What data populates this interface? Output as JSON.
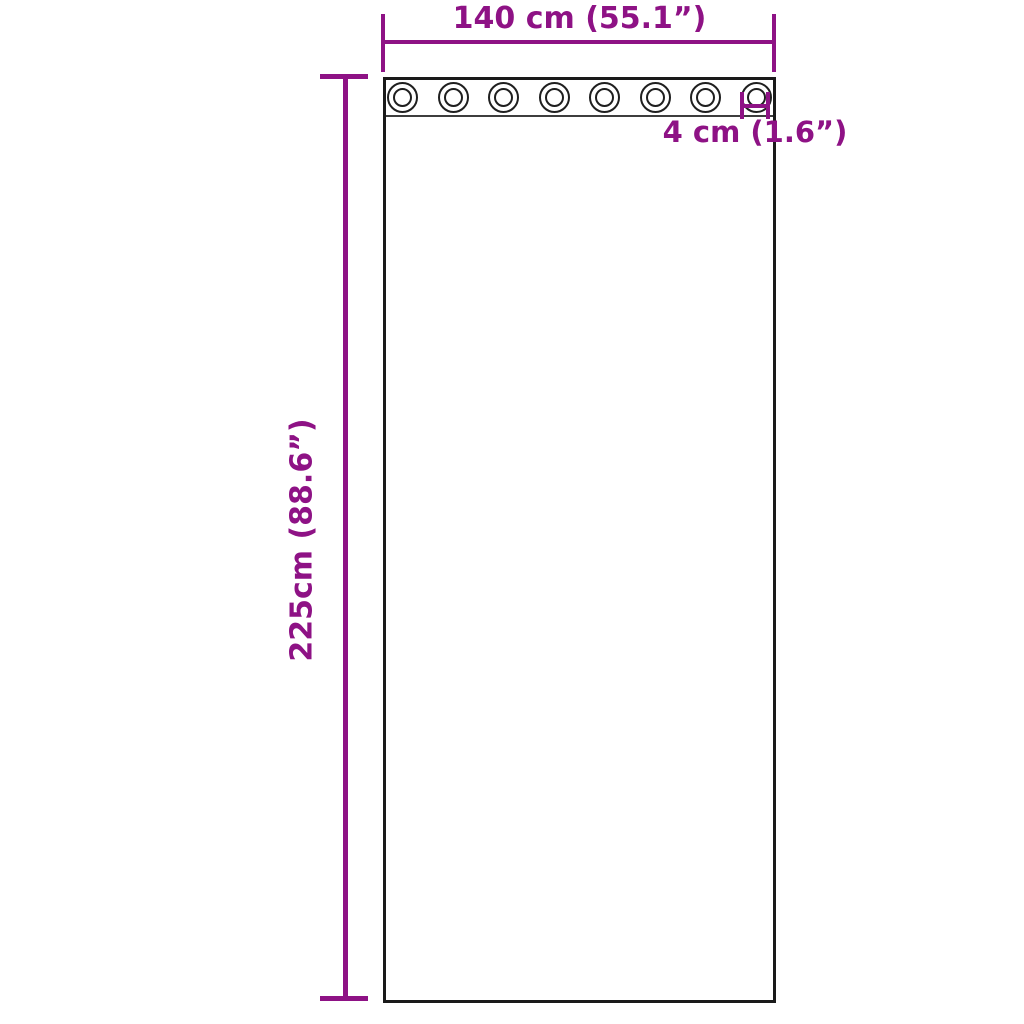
{
  "diagram": {
    "type": "curtain-dimension-diagram",
    "curtain": {
      "grommet_count": 8
    },
    "dimensions": {
      "width": {
        "label": "140 cm (55.1”)",
        "value": "140 cm",
        "inches": "55.1”"
      },
      "height": {
        "label": "225cm (88.6”)",
        "value": "225cm",
        "inches": "88.6”"
      },
      "grommet_diameter": {
        "label": "4 cm (1.6”)",
        "value": "4 cm",
        "inches": "1.6”"
      }
    },
    "colors": {
      "dimension_accent": "#8E1285",
      "outline": "#1a1a1a",
      "background": "#ffffff"
    }
  }
}
